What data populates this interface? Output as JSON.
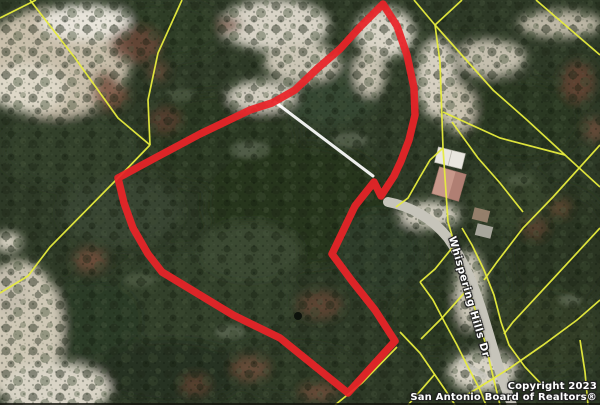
{
  "map": {
    "description": "Aerial MLS parcel map with outlined property",
    "road_label": "Whispering Hills Dr",
    "copyright": {
      "line1": "Copyright 2023",
      "line2": "San Antonio Board of Realtors®"
    },
    "overlays": {
      "property_boundary_color": "#ea2328",
      "parcel_line_color": "#e7ec3d",
      "easement_line_color": "#ffffff",
      "road_color": "#c6c4ba"
    }
  }
}
